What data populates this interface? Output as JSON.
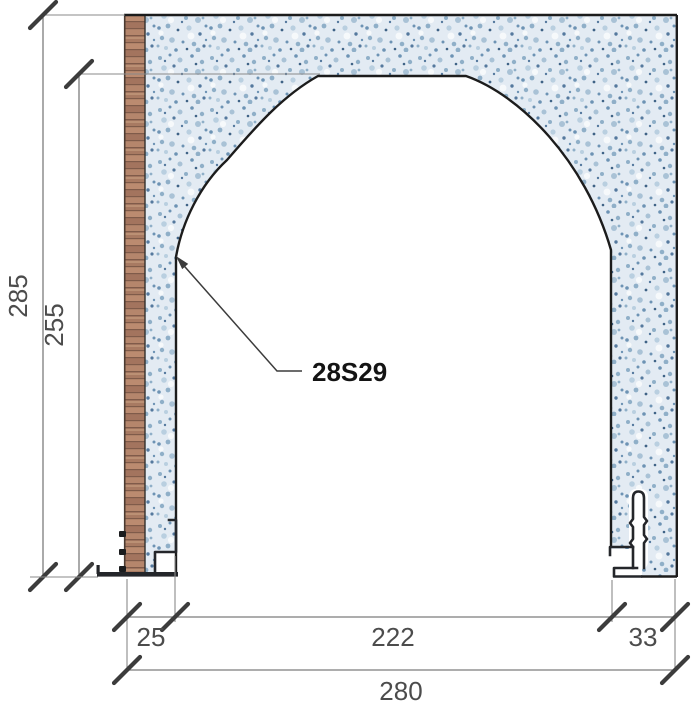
{
  "drawing": {
    "callout_label": "28S29",
    "dimensions": {
      "overall_height": "285",
      "opening_height": "255",
      "left_jamb": "25",
      "opening_width": "222",
      "right_jamb": "33",
      "overall_width": "280"
    },
    "colors": {
      "plaster_base": "#e3ebf3",
      "plaster_speckle": "#6d93b4",
      "wood_base": "#b08068",
      "wood_band": "#7f5b4a",
      "outline": "#1c1c1c",
      "metal": "#24262a",
      "dimension_line": "#7c7c7c",
      "dimension_text": "#4c4c4c",
      "callout_text": "#141414"
    }
  }
}
